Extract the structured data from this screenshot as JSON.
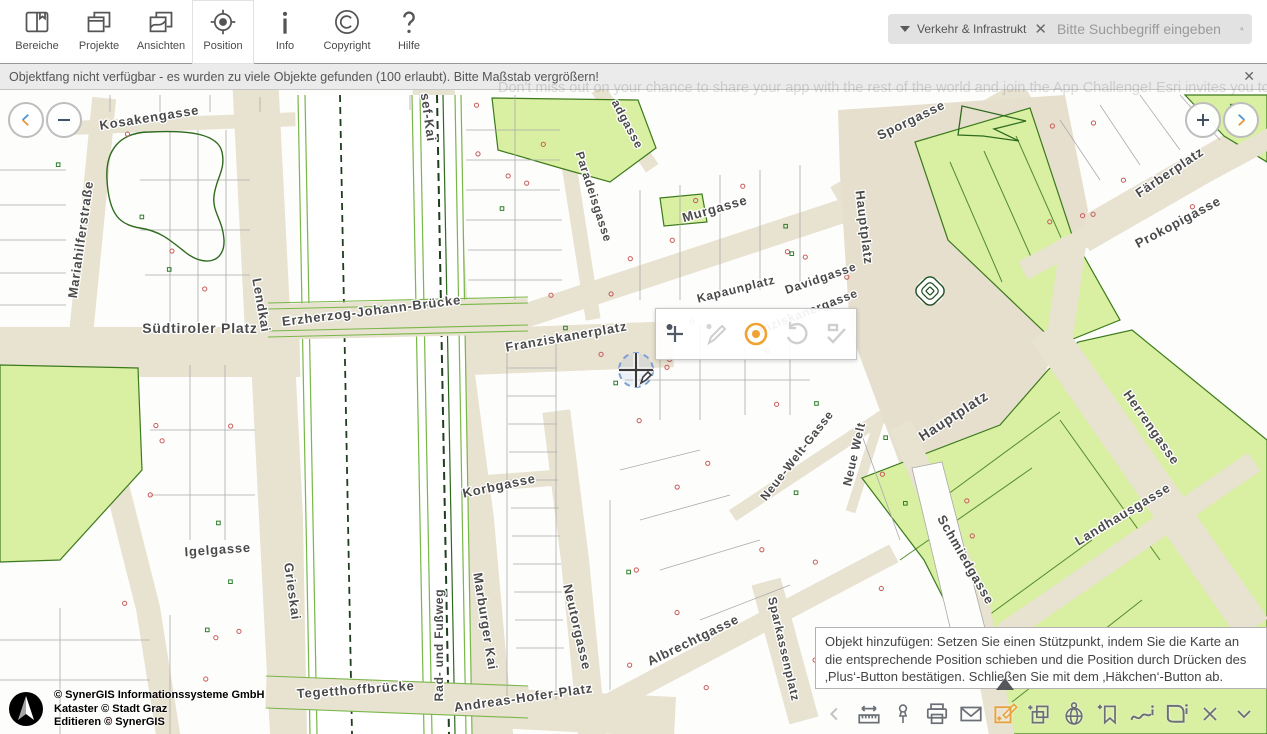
{
  "topbar": {
    "items": [
      {
        "label": "Bereiche",
        "icon": "book-icon"
      },
      {
        "label": "Projekte",
        "icon": "windows-stack-icon"
      },
      {
        "label": "Ansichten",
        "icon": "map-sheets-icon"
      },
      {
        "label": "Position",
        "icon": "crosshair-target-icon",
        "selected": true
      },
      {
        "label": "Info",
        "icon": "info-icon"
      },
      {
        "label": "Copyright",
        "icon": "copyright-icon"
      },
      {
        "label": "Hilfe",
        "icon": "question-icon"
      }
    ]
  },
  "search": {
    "category": "Verkehr & Infrastrukt",
    "clear_glyph": "✕",
    "placeholder": "Bitte Suchbegriff eingeben",
    "icon": "search-icon"
  },
  "notification": {
    "text": "Objektfang nicht verfügbar - es wurden zu viele Objekte gefunden (100 erlaubt). Bitte Maßstab vergrößern!",
    "close_glyph": "✕"
  },
  "watermark": {
    "text": "Don't miss out on your chance to share your app with the rest of the world and join the App Challenge! Esri invites you to apply you"
  },
  "map_nav": {
    "back": "chevron-left",
    "zoom_out": "−",
    "zoom_in": "+",
    "forward": "chevron-right"
  },
  "edit_toolbar": {
    "tools": [
      "add-vertex-icon",
      "pencil-icon",
      "record-point-icon",
      "undo-icon",
      "finish-check-icon"
    ],
    "active_color": "#f0a232"
  },
  "tooltip": {
    "text": "Objekt hinzufügen: Setzen Sie einen Stützpunkt, indem Sie die Karte an die entsprechende Position schieben und die Position durch Drücken des ‚Plus‘-Button bestätigen. Schließen Sie mit dem ‚Häkchen‘-Button ab."
  },
  "bottom_toolbar": {
    "tools": [
      "chevron-left-icon",
      "measure-icon",
      "pin-icon",
      "print-icon",
      "mail-icon",
      "edit-object-icon",
      "add-layers-icon",
      "globe-pin-icon",
      "bookmark-add-icon",
      "route-info-icon",
      "area-info-icon",
      "close-icon",
      "collapse-icon"
    ],
    "active_tool": "edit-object-icon",
    "active_color": "#e8a23b"
  },
  "attribution": {
    "lines": [
      "© SynerGIS Informationssysteme GmbH",
      "Kataster © Stadt Graz",
      "Editieren © SynerGIS"
    ]
  },
  "colors": {
    "street_beige": "#e8e2d1",
    "building_white": "#fdfdfb",
    "green_fill": "#d9efa2",
    "green_line": "#3c7a1c",
    "label_gray": "#4a4a4a",
    "accent_orange": "#e8a23b",
    "nav_blue": "#4a90d9"
  },
  "map_labels": [
    {
      "t": "Kosakengasse",
      "x": 150,
      "y": 122,
      "r": -9,
      "s": 13
    },
    {
      "t": "Mariahilferstraße",
      "x": 85,
      "y": 240,
      "r": -82,
      "s": 13
    },
    {
      "t": "Lendkai",
      "x": 257,
      "y": 306,
      "r": 80,
      "s": 13
    },
    {
      "t": "sef-Kai",
      "x": 424,
      "y": 118,
      "r": 82,
      "s": 13
    },
    {
      "t": "adgasse",
      "x": 624,
      "y": 126,
      "r": 62,
      "s": 12
    },
    {
      "t": "Paradeisgasse",
      "x": 590,
      "y": 198,
      "r": 72,
      "s": 12
    },
    {
      "t": "Südtiroler Platz",
      "x": 200,
      "y": 333,
      "r": 0,
      "s": 14
    },
    {
      "t": "Erzherzog-Johann-Brücke",
      "x": 372,
      "y": 315,
      "r": -7,
      "s": 13
    },
    {
      "t": "Murgasse",
      "x": 716,
      "y": 213,
      "r": -16,
      "s": 13
    },
    {
      "t": "Kapaunplatz",
      "x": 737,
      "y": 293,
      "r": -14,
      "s": 12
    },
    {
      "t": "Franziskanergasse",
      "x": 802,
      "y": 318,
      "r": -21,
      "s": 12
    },
    {
      "t": "Franziskanerplatz",
      "x": 567,
      "y": 341,
      "r": -10,
      "s": 13
    },
    {
      "t": "Hauptplatz",
      "x": 860,
      "y": 228,
      "r": 83,
      "s": 13
    },
    {
      "t": "Davidgasse",
      "x": 822,
      "y": 282,
      "r": -19,
      "s": 12
    },
    {
      "t": "Hauptplatz",
      "x": 956,
      "y": 420,
      "r": -33,
      "s": 14
    },
    {
      "t": "Sporgasse",
      "x": 913,
      "y": 124,
      "r": -26,
      "s": 13
    },
    {
      "t": "Färberplatz",
      "x": 1172,
      "y": 176,
      "r": -34,
      "s": 13
    },
    {
      "t": "Prokopigasse",
      "x": 1180,
      "y": 226,
      "r": -28,
      "s": 13
    },
    {
      "t": "Herrengasse",
      "x": 1148,
      "y": 430,
      "r": 55,
      "s": 13
    },
    {
      "t": "Landhausgasse",
      "x": 1125,
      "y": 518,
      "r": -31,
      "s": 13
    },
    {
      "t": "Schmiedgasse",
      "x": 962,
      "y": 562,
      "r": 60,
      "s": 13
    },
    {
      "t": "Neue-Welt-Gasse",
      "x": 800,
      "y": 458,
      "r": -52,
      "s": 12
    },
    {
      "t": "Neue Welt",
      "x": 858,
      "y": 455,
      "r": -77,
      "s": 12
    },
    {
      "t": "Grieskai",
      "x": 288,
      "y": 592,
      "r": 82,
      "s": 13
    },
    {
      "t": "Igelgasse",
      "x": 218,
      "y": 554,
      "r": -4,
      "s": 13
    },
    {
      "t": "Korbgasse",
      "x": 500,
      "y": 490,
      "r": -12,
      "s": 13
    },
    {
      "t": "Marburger Kai",
      "x": 481,
      "y": 622,
      "r": 81,
      "s": 13
    },
    {
      "t": "Rad- und Fußweg",
      "x": 443,
      "y": 645,
      "r": -90,
      "s": 12
    },
    {
      "t": "Neutorgasse",
      "x": 573,
      "y": 628,
      "r": 77,
      "s": 13
    },
    {
      "t": "Albrechtgasse",
      "x": 695,
      "y": 644,
      "r": -26,
      "s": 13
    },
    {
      "t": "Sparkassenplatz",
      "x": 780,
      "y": 650,
      "r": 77,
      "s": 12
    },
    {
      "t": "Andreas-Hofer-Platz",
      "x": 524,
      "y": 702,
      "r": -8,
      "s": 13
    },
    {
      "t": "Tegetthoffbrücke",
      "x": 356,
      "y": 694,
      "r": -4,
      "s": 13
    }
  ]
}
